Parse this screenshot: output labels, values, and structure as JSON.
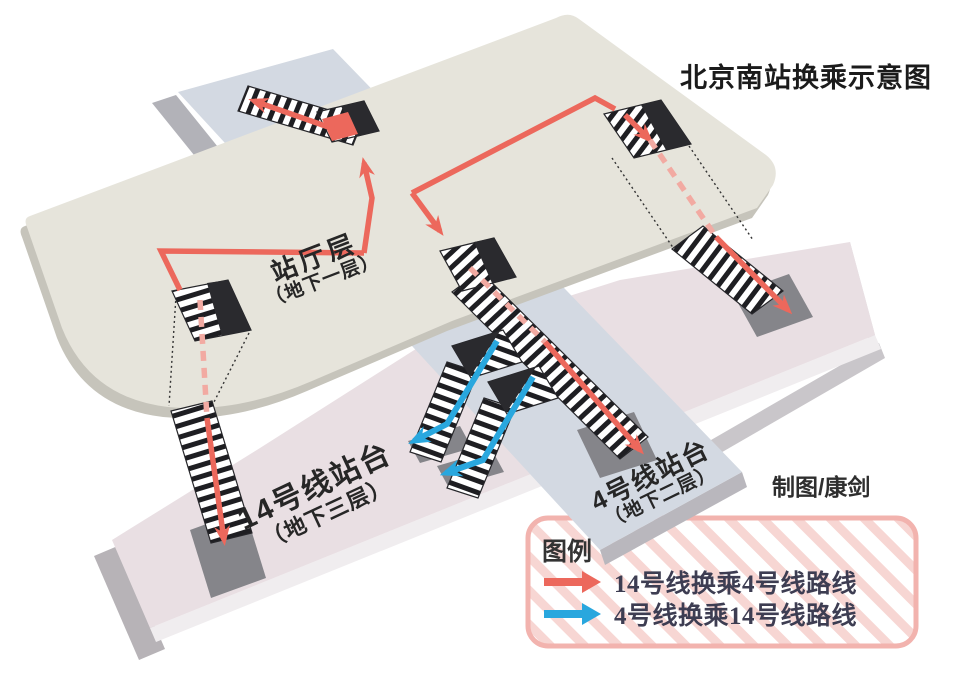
{
  "title": "北京南站换乘示意图",
  "credit": "制图/康剑",
  "levels": {
    "hall": {
      "name": "站厅层",
      "floor": "（地下一层）"
    },
    "line14_platform": {
      "name": "14号线站台",
      "floor": "（地下三层）"
    },
    "line4_platform": {
      "name": "4号线站台",
      "floor": "（地下二层）"
    }
  },
  "legend": {
    "title": "图例",
    "items": [
      {
        "label": "14号线换乘4号线路线",
        "color": "#ec685c",
        "icon": "right-arrow"
      },
      {
        "label": "4号线换乘14号线路线",
        "color": "#29a7de",
        "icon": "right-arrow"
      }
    ]
  },
  "colors": {
    "hall_surface": "#e6e4db",
    "hall_side": "#c6c4bb",
    "line4_surface": "#d3d9e2",
    "line14_surface": "#e9dfe3",
    "landing_pad": "#85858a",
    "opening": "#2a2a2e",
    "route_14_to_4": "#ec685c",
    "route_4_to_14": "#29a7de",
    "legend_border": "#f2b3ae",
    "legend_stripe": "#f7d6d3"
  }
}
